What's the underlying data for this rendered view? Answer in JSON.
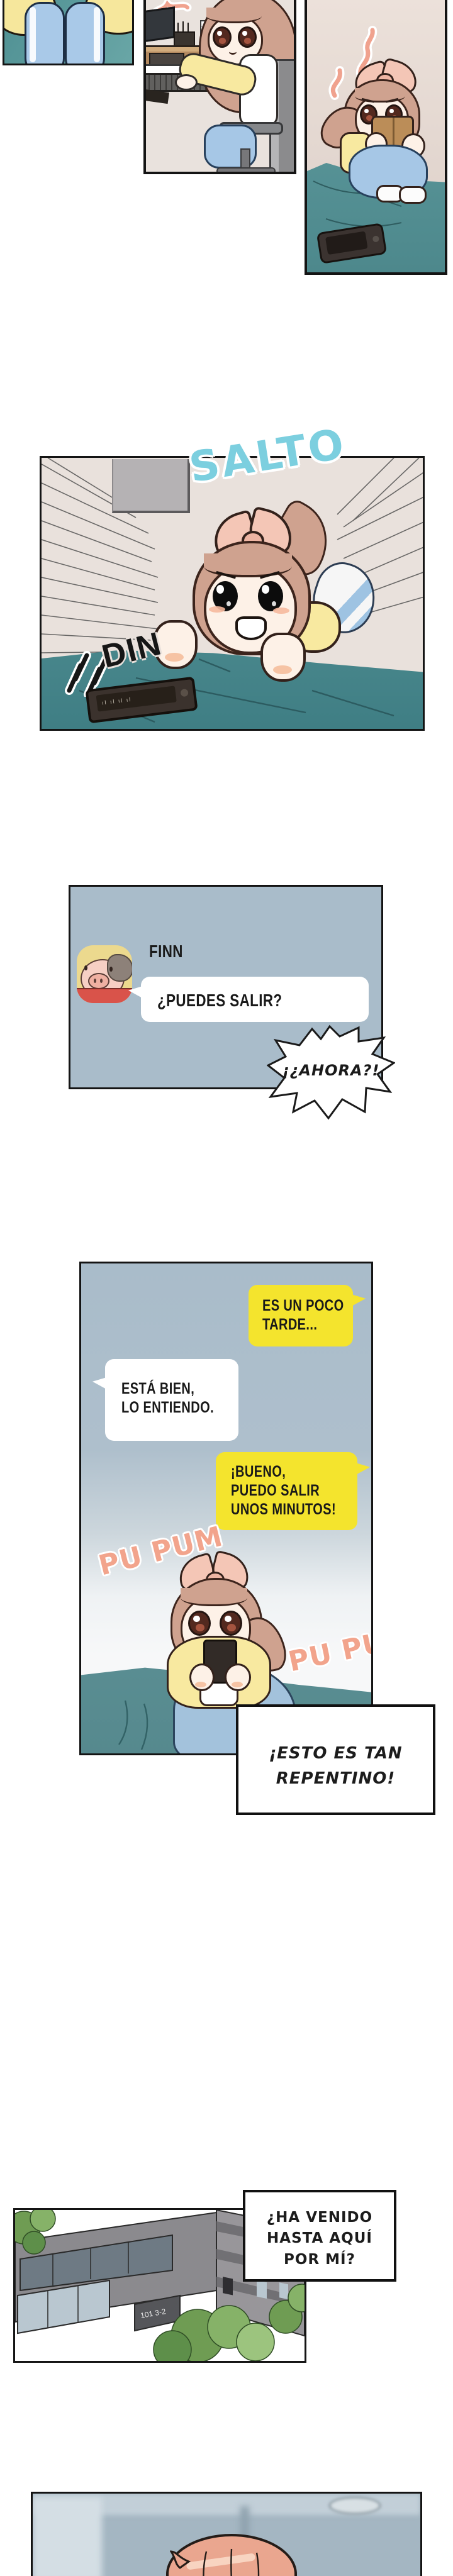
{
  "meta": {
    "kind": "webtoon-comic-strip",
    "language": "es"
  },
  "colors": {
    "chat_panel_bg": "#a9bcca",
    "yellow_bubble": "#f4e42d",
    "white_bubble": "#ffffff",
    "sfx_salmon": "#f2a48c",
    "sfx_cyan": "#7ccfdf",
    "bed_teal": "#5f9b9e",
    "wall_beige": "#e9e0da",
    "pants_blue": "#a6c7e6",
    "sweater_yellow": "#f8eba3",
    "hair_brown": "#cfa28f",
    "hair_salmon": "#eaa68f",
    "ink": "#141414"
  },
  "panels": {
    "salto": {
      "sfx_jump": "SALTO",
      "sfx_din": "DIN"
    },
    "chat1": {
      "contact_name": "FINN",
      "message": "¿PUEDES SALIR?",
      "reaction": "¡¿AHORA?!"
    },
    "chat2": {
      "bubble_late": {
        "line1": "ES UN POCO",
        "line2": "TARDE..."
      },
      "bubble_ok": {
        "line1": "ESTÁ BIEN,",
        "line2": "LO ENTIENDO."
      },
      "bubble_out": {
        "line1": "¡BUENO,",
        "line2": "PUEDO SALIR",
        "line3": "UNOS MINUTOS!"
      },
      "sfx_heartbeat1": "PU PUM",
      "sfx_heartbeat2": "PU PUM"
    },
    "caption_sudden": {
      "line1": "¡ESTO ES TAN",
      "line2": "REPENTINO!"
    },
    "caption_came": {
      "line1": "¿HA VENIDO",
      "line2": "HASTA AQUÍ",
      "line3": "POR MÍ?"
    },
    "building": {
      "sign": "101 3-2"
    }
  }
}
